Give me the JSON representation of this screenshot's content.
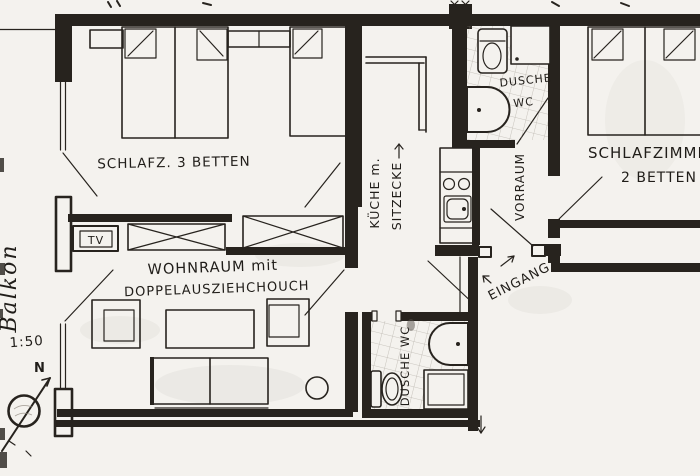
{
  "colors": {
    "ink": "#27231e",
    "paper": "#f4f2ee",
    "pencil_gray": "#8d867c"
  },
  "plan": {
    "scale_label": "1:50",
    "north_label": "N"
  },
  "labels": {
    "balcony": "Balkon",
    "bedroom3": "SCHLAFZ. 3 BETTEN",
    "tv": "TV",
    "living_line1": "WOHNRAUM mit",
    "living_line2": "DOPPELAUSZIEHCHOUCH",
    "kitchen_line1": "KÜCHE m.",
    "kitchen_line2": "SITZECKE",
    "bath_top_line1": "DUSCHE",
    "bath_top_line2": "WC",
    "hall": "VORRAUM",
    "entrance": "EINGANG",
    "bedroom2_line1": "SCHLAFZIMMER",
    "bedroom2_line2": "2 BETTEN",
    "bath_bottom": "DUSCHE WC"
  }
}
